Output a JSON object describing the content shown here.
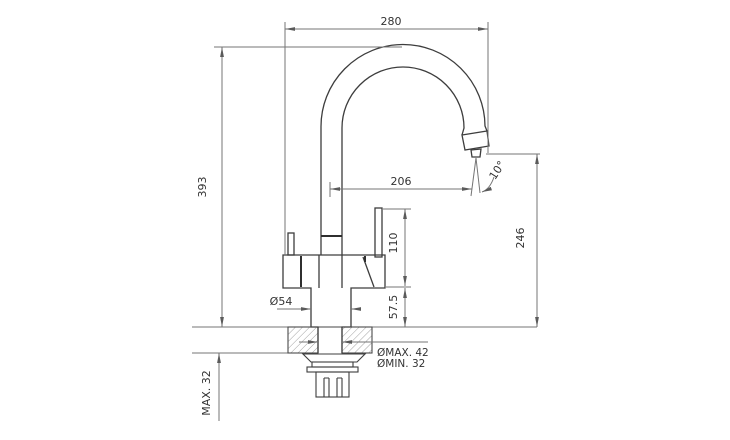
{
  "drawing": {
    "dimensions": {
      "spout_span": "280",
      "total_height": "393",
      "spout_reach": "206",
      "stream_angle": "10°",
      "lever_height": "110",
      "outlet_clearance": "246",
      "body_diameter": "Ø54",
      "base_to_counter": "57.5",
      "hole_diameter_max": "ØMAX. 42",
      "hole_diameter_min": "ØMIN. 32",
      "counter_thickness_max": "MAX. 32"
    }
  }
}
